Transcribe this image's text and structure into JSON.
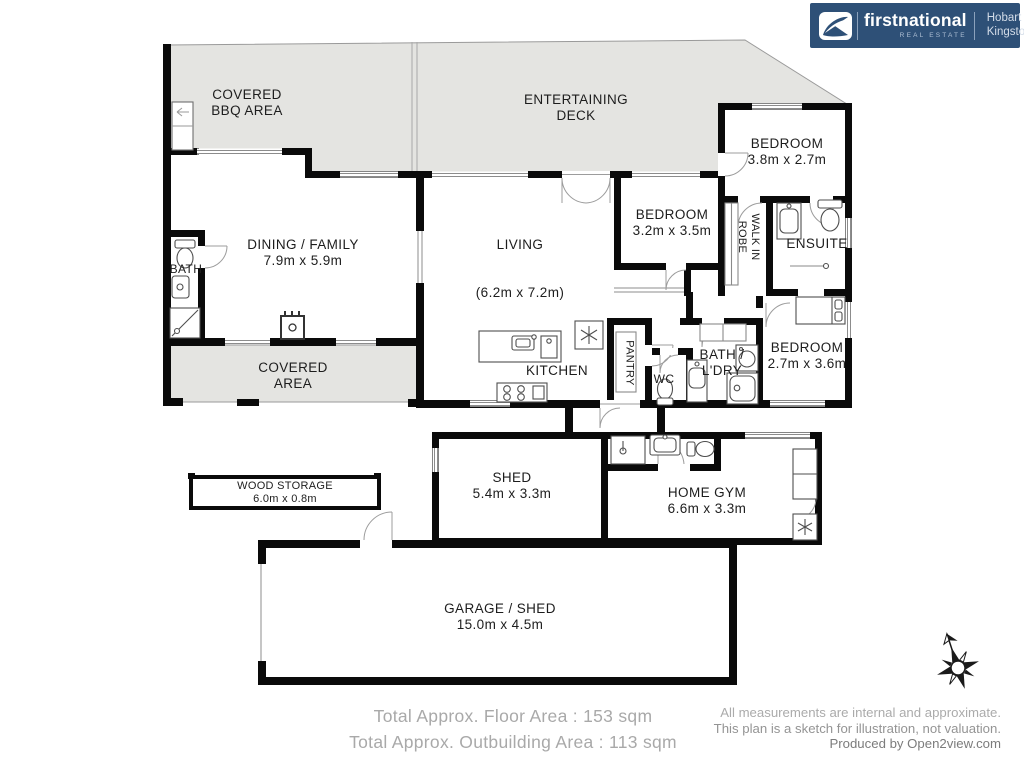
{
  "branding": {
    "logo_text": "firstnational",
    "logo_sub": "REAL ESTATE",
    "office_line1": "Hobart",
    "office_line2": "Kingston"
  },
  "rooms": {
    "covered_bbq": {
      "line1": "COVERED",
      "line2": "BBQ AREA"
    },
    "entertaining_deck": {
      "line1": "ENTERTAINING",
      "line2": "DECK"
    },
    "bedroom1": {
      "line1": "BEDROOM",
      "line2": "3.8m x 2.7m"
    },
    "dining_family": {
      "line1": "DINING / FAMILY",
      "line2": "7.9m x 5.9m"
    },
    "bath": {
      "line1": "BATH"
    },
    "living": {
      "line1": "LIVING",
      "line2": "(6.2m x 7.2m)"
    },
    "bedroom2": {
      "line1": "BEDROOM",
      "line2": "3.2m x 3.5m"
    },
    "walk_in_robe": {
      "line1": "WALK IN",
      "line2": "ROBE"
    },
    "ensuite": {
      "line1": "ENSUITE"
    },
    "covered_area": {
      "line1": "COVERED",
      "line2": "AREA"
    },
    "kitchen": {
      "line1": "KITCHEN"
    },
    "pantry": {
      "line1": "PANTRY"
    },
    "wc": {
      "line1": "WC"
    },
    "bath_ldry": {
      "line1": "BATH /",
      "line2": "L'DRY"
    },
    "bedroom3": {
      "line1": "BEDROOM",
      "line2": "2.7m x 3.6m"
    },
    "shed": {
      "line1": "SHED",
      "line2": "5.4m x 3.3m"
    },
    "home_gym": {
      "line1": "HOME GYM",
      "line2": "6.6m x 3.3m"
    },
    "wood_storage": {
      "line1": "WOOD STORAGE",
      "line2": "6.0m x 0.8m"
    },
    "garage_shed": {
      "line1": "GARAGE / SHED",
      "line2": "15.0m x 4.5m"
    }
  },
  "totals": {
    "floor_area": "Total Approx. Floor Area : 153 sqm",
    "outbuilding_area": "Total Approx. Outbuilding Area : 113 sqm"
  },
  "disclaimer": {
    "line1": "All measurements are internal and approximate.",
    "line2": "This plan is a sketch for illustration, not valuation.",
    "credit": "Produced by Open2view.com"
  },
  "icons": {
    "brand_mark": "firstnational-swoosh",
    "compass": "compass-rose"
  },
  "colors": {
    "brand_blue": "#2E5077",
    "deck_gray": "#E4E4E1",
    "wall_black": "#0A0A0A",
    "totals_text": "#A9A9A9",
    "disclaimer_text": "#8F8F8F"
  }
}
